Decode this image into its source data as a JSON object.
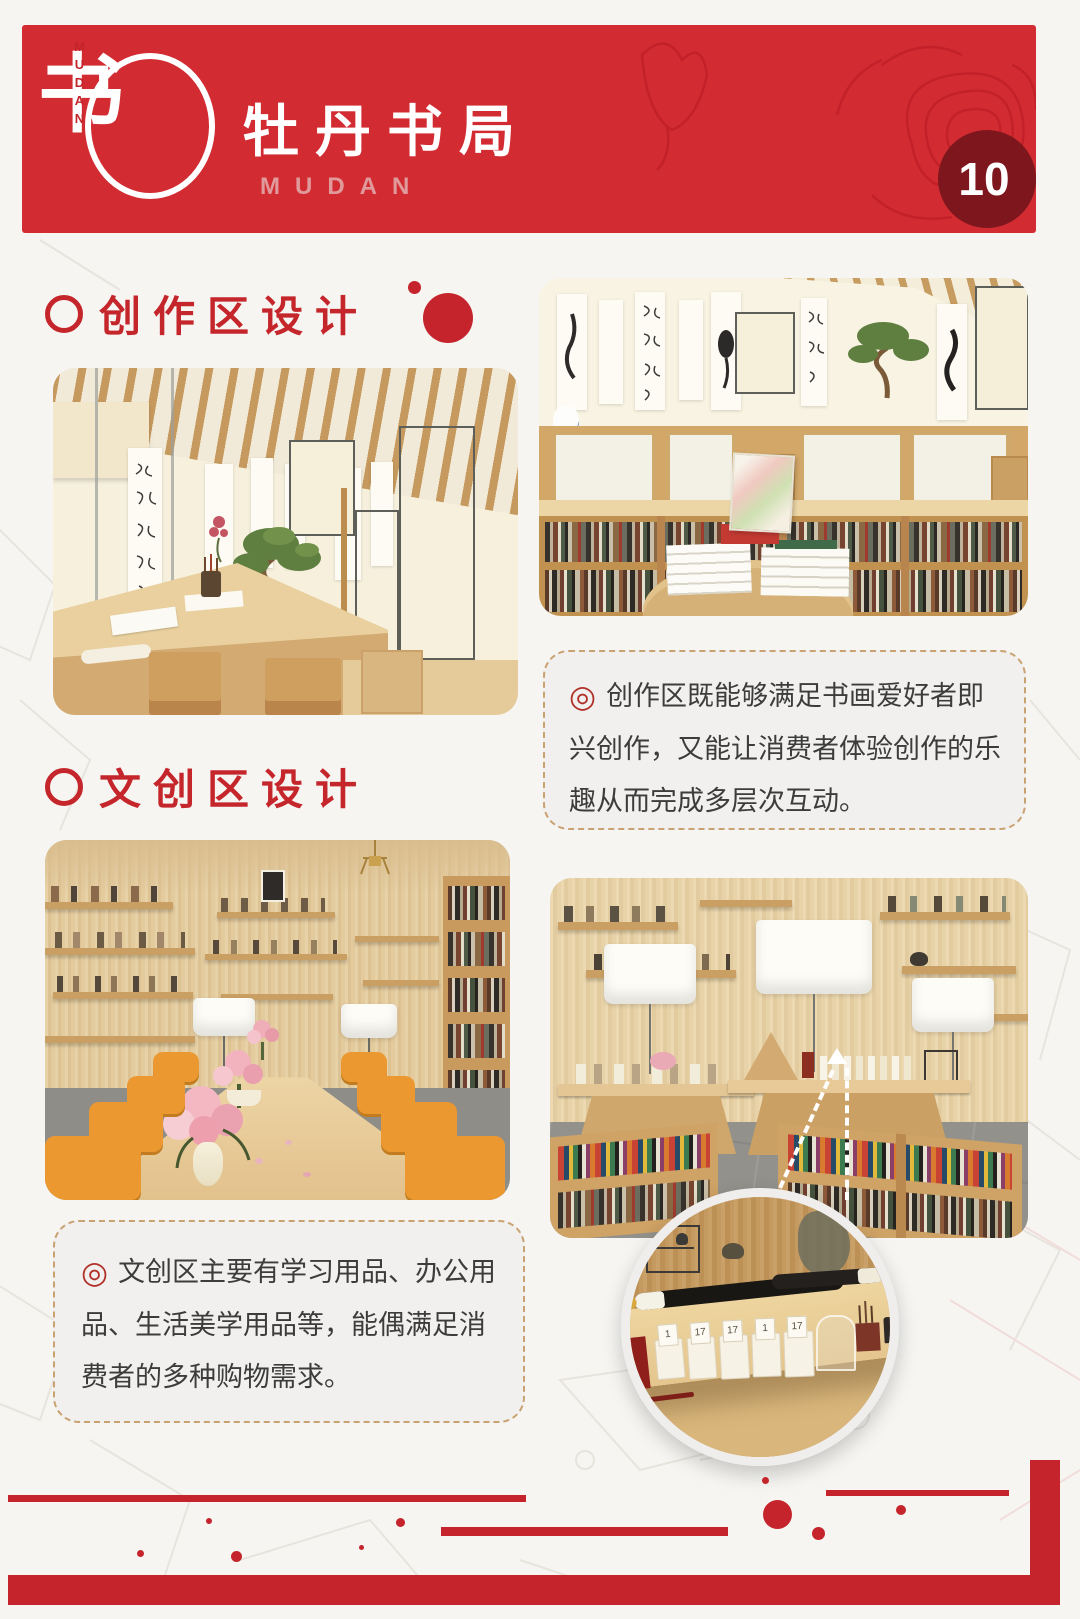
{
  "page": {
    "number": "10"
  },
  "header": {
    "logo": {
      "glyph": "书",
      "vertical_text": "MUDAN"
    },
    "title": "牡丹书局",
    "subtitle": "MUDAN"
  },
  "sections": [
    {
      "id": "creation-area",
      "title": "创作区设计"
    },
    {
      "id": "cultural-area",
      "title": "文创区设计"
    }
  ],
  "callouts": [
    {
      "icon_glyph": "◎",
      "text": "创作区既能够满足书画爱好者即兴创作，又能让消费者体验创作的乐趣从而完成多层次互动。"
    },
    {
      "icon_glyph": "◎",
      "text": "文创区主要有学习用品、办公用品、生活美学用品等，能偶满足消费者的多种购物需求。"
    }
  ],
  "detail": {
    "tags": [
      "1",
      "17",
      "17",
      "1",
      "17"
    ]
  },
  "colors": {
    "banner_red": "#d22c32",
    "badge_dark_red": "#7d161d",
    "heading_red": "#c5262b",
    "callout_border_tan": "#c9a272",
    "callout_bg": "#f1f0ee",
    "decor_red": "#c5242c"
  }
}
